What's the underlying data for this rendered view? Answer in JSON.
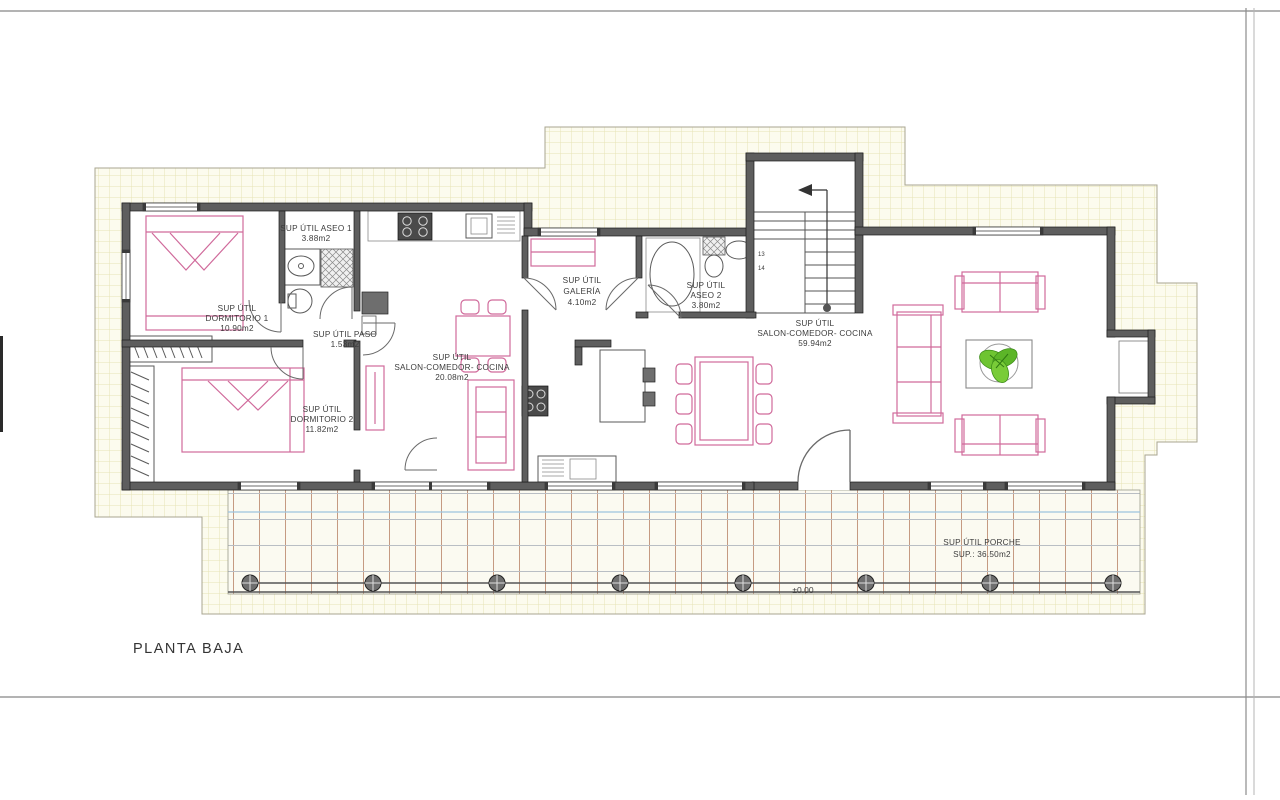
{
  "drawing": {
    "title": "PLANTA BAJA",
    "level_mark": "±0.00",
    "stair_step_numbers": [
      "13",
      "14"
    ]
  },
  "rooms": {
    "dormitorio1": {
      "lines": [
        "SUP ÚTIL",
        "DORMITORIO 1",
        "10.90m2"
      ]
    },
    "aseo1": {
      "lines": [
        "SUP ÚTIL ASEO 1",
        "3.88m2"
      ]
    },
    "paso": {
      "lines": [
        "SUP ÚTIL PASO",
        "1.53m2"
      ]
    },
    "salon_cocina1": {
      "lines": [
        "SUP ÚTIL",
        "SALON-COMEDOR- COCINA",
        "20.08m2"
      ]
    },
    "dormitorio2": {
      "lines": [
        "SUP ÚTIL",
        "DORMITORIO 2",
        "11.82m2"
      ]
    },
    "galeria": {
      "lines": [
        "SUP ÚTIL",
        "GALERÍA",
        "4.10m2"
      ]
    },
    "aseo2": {
      "lines": [
        "SUP ÚTIL",
        "ASEO 2",
        "3.80m2"
      ]
    },
    "salon_cocina2": {
      "lines": [
        "SUP ÚTIL",
        "SALON-COMEDOR- COCINA",
        "59.94m2"
      ]
    },
    "porche": {
      "lines": [
        "SUP ÚTIL PORCHE",
        "SUP.: 36.50m2"
      ]
    }
  },
  "colors": {
    "wall_gray": "#5e5e5e",
    "furniture_pink": "#d06a9b",
    "plant_green": "#63bd2b",
    "terrain_bg": "#fcfbee",
    "terrain_grid": "#e6e3b5",
    "porch_grid_v": "#c59a82",
    "porch_grid_h": "#b9bec4",
    "porch_blue_line": "#9cc3de",
    "ink": "#3c3c3c"
  }
}
